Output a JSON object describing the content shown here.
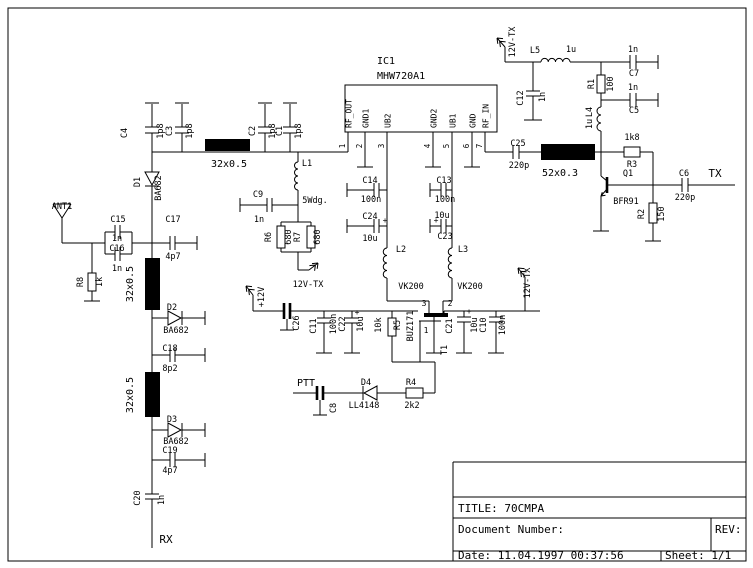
{
  "schematic": {
    "ic": {
      "ref": "IC1",
      "part": "MHW720A1",
      "pin_names": [
        "RF_OUT",
        "GND1",
        "UB2",
        "GND2",
        "UB1",
        "GND",
        "RF_IN"
      ],
      "pin_numbers": [
        "1",
        "2",
        "3",
        "4",
        "5",
        "6",
        "7"
      ]
    },
    "title_block": {
      "title": "TITLE: 70CMPA",
      "document_number": "Document Number:",
      "rev": "REV:",
      "date": "Date: 11.04.1997  00:37:56",
      "sheet": "Sheet: 1/1"
    },
    "labels": [
      {
        "n": "c4-ref",
        "t": "C4",
        "x": 127,
        "y": 133,
        "r": -90
      },
      {
        "n": "c4-val",
        "t": "1p8",
        "x": 163,
        "y": 131,
        "r": -90
      },
      {
        "n": "c3-ref",
        "t": "C3",
        "x": 172,
        "y": 131,
        "r": -90
      },
      {
        "n": "c3-val",
        "t": "1p8",
        "x": 192,
        "y": 131,
        "r": -90
      },
      {
        "n": "c2-ref",
        "t": "C2",
        "x": 255,
        "y": 131,
        "r": -90
      },
      {
        "n": "c2-val",
        "t": "1p8",
        "x": 275,
        "y": 131,
        "r": -90
      },
      {
        "n": "c1-ref",
        "t": "C1",
        "x": 282,
        "y": 131,
        "r": -90
      },
      {
        "n": "c1-val",
        "t": "1p8",
        "x": 301,
        "y": 131,
        "r": -90
      },
      {
        "n": "coax1-label",
        "t": "32x0.5",
        "x": 229,
        "y": 167,
        "s": 10
      },
      {
        "n": "ant-ref",
        "t": "ANT1",
        "x": 62,
        "y": 209
      },
      {
        "n": "d1-ref",
        "t": "D1",
        "x": 140,
        "y": 182,
        "r": -90
      },
      {
        "n": "d1-val",
        "t": "BA682",
        "x": 161,
        "y": 188,
        "r": -90
      },
      {
        "n": "c15-ref",
        "t": "C15",
        "x": 118,
        "y": 222
      },
      {
        "n": "c15-val",
        "t": "1n",
        "x": 117,
        "y": 241
      },
      {
        "n": "c16-ref",
        "t": "C16",
        "x": 117,
        "y": 251
      },
      {
        "n": "c16-val",
        "t": "1n",
        "x": 117,
        "y": 271
      },
      {
        "n": "c17-ref",
        "t": "C17",
        "x": 173,
        "y": 222
      },
      {
        "n": "c17-val",
        "t": "4p7",
        "x": 173,
        "y": 259
      },
      {
        "n": "r8-ref",
        "t": "R8",
        "x": 83,
        "y": 282,
        "r": -90
      },
      {
        "n": "r8-val",
        "t": "1k",
        "x": 102,
        "y": 282,
        "r": -90
      },
      {
        "n": "coax2-label",
        "t": "32x0.5",
        "x": 133,
        "y": 284,
        "r": -90,
        "s": 10
      },
      {
        "n": "d2-ref",
        "t": "D2",
        "x": 172,
        "y": 310
      },
      {
        "n": "d2-val",
        "t": "BA682",
        "x": 176,
        "y": 333
      },
      {
        "n": "c18-ref",
        "t": "C18",
        "x": 170,
        "y": 351
      },
      {
        "n": "c18-val",
        "t": "8p2",
        "x": 170,
        "y": 371
      },
      {
        "n": "coax3-label",
        "t": "32x0.5",
        "x": 133,
        "y": 395,
        "r": -90,
        "s": 10
      },
      {
        "n": "d3-ref",
        "t": "D3",
        "x": 172,
        "y": 422
      },
      {
        "n": "d3-val",
        "t": "BA682",
        "x": 176,
        "y": 444
      },
      {
        "n": "c19-ref",
        "t": "C19",
        "x": 170,
        "y": 453
      },
      {
        "n": "c19-val",
        "t": "4p7",
        "x": 170,
        "y": 473
      },
      {
        "n": "c20-ref",
        "t": "C20",
        "x": 140,
        "y": 498,
        "r": -90
      },
      {
        "n": "c20-val",
        "t": "1n",
        "x": 164,
        "y": 500,
        "r": -90
      },
      {
        "n": "rx-port",
        "t": "RX",
        "x": 166,
        "y": 543,
        "s": 11
      },
      {
        "n": "l1-ref",
        "t": "L1",
        "x": 307,
        "y": 166
      },
      {
        "n": "c9-ref",
        "t": "C9",
        "x": 258,
        "y": 197
      },
      {
        "n": "c9-val",
        "t": "1n",
        "x": 259,
        "y": 222
      },
      {
        "n": "l1-note",
        "t": "5Wdg.",
        "x": 315,
        "y": 203
      },
      {
        "n": "r6-ref",
        "t": "R6",
        "x": 271,
        "y": 237,
        "r": -90
      },
      {
        "n": "r6-val",
        "t": "680",
        "x": 291,
        "y": 237,
        "r": -90
      },
      {
        "n": "r7-ref",
        "t": "R7",
        "x": 300,
        "y": 237,
        "r": -90
      },
      {
        "n": "r7-val",
        "t": "680",
        "x": 320,
        "y": 237,
        "r": -90
      },
      {
        "n": "supply-12vtx-mid",
        "t": "12V-TX",
        "x": 308,
        "y": 287
      },
      {
        "n": "supply-plus12v",
        "t": "+12V",
        "x": 264,
        "y": 297,
        "r": -90
      },
      {
        "n": "c14-ref",
        "t": "C14",
        "x": 370,
        "y": 183
      },
      {
        "n": "c14-val",
        "t": "100n",
        "x": 371,
        "y": 202
      },
      {
        "n": "c24-ref",
        "t": "C24",
        "x": 370,
        "y": 219
      },
      {
        "n": "c24-plus",
        "t": "+",
        "x": 385,
        "y": 223,
        "s": 8
      },
      {
        "n": "c24-val",
        "t": "10u",
        "x": 370,
        "y": 241
      },
      {
        "n": "l2-ref",
        "t": "L2",
        "x": 401,
        "y": 252
      },
      {
        "n": "l2-val",
        "t": "VK200",
        "x": 411,
        "y": 289
      },
      {
        "n": "c13-ref",
        "t": "C13",
        "x": 444,
        "y": 183
      },
      {
        "n": "c13-val",
        "t": "100n",
        "x": 445,
        "y": 202
      },
      {
        "n": "c23-val",
        "t": "10u",
        "x": 442,
        "y": 218
      },
      {
        "n": "c23-plus",
        "t": "+",
        "x": 436,
        "y": 223,
        "s": 8
      },
      {
        "n": "c23-ref",
        "t": "C23",
        "x": 445,
        "y": 239
      },
      {
        "n": "l3-ref",
        "t": "L3",
        "x": 463,
        "y": 252
      },
      {
        "n": "l3-val",
        "t": "VK200",
        "x": 470,
        "y": 289
      },
      {
        "n": "c26-ref",
        "t": "C26",
        "x": 299,
        "y": 323,
        "r": -90
      },
      {
        "n": "c11-ref",
        "t": "C11",
        "x": 316,
        "y": 326,
        "r": -90
      },
      {
        "n": "c11-val",
        "t": "100n",
        "x": 336,
        "y": 324,
        "r": -90
      },
      {
        "n": "c22-ref",
        "t": "C22",
        "x": 345,
        "y": 324,
        "r": -90
      },
      {
        "n": "c22-plus",
        "t": "+",
        "x": 357,
        "y": 315,
        "s": 8
      },
      {
        "n": "c22-val",
        "t": "10u",
        "x": 363,
        "y": 324,
        "r": -90
      },
      {
        "n": "r5-val",
        "t": "10k",
        "x": 381,
        "y": 325,
        "r": -90
      },
      {
        "n": "r5-ref",
        "t": "R5",
        "x": 400,
        "y": 325,
        "r": -90
      },
      {
        "n": "t1-val",
        "t": "BUZ171",
        "x": 413,
        "y": 326,
        "r": -90
      },
      {
        "n": "t1-pin3",
        "t": "3",
        "x": 424,
        "y": 306,
        "s": 8
      },
      {
        "n": "t1-pin2",
        "t": "2",
        "x": 450,
        "y": 306,
        "s": 8
      },
      {
        "n": "t1-pin1",
        "t": "1",
        "x": 426,
        "y": 333,
        "s": 8
      },
      {
        "n": "t1-ref",
        "t": "T1",
        "x": 447,
        "y": 350,
        "r": -90
      },
      {
        "n": "c21-ref",
        "t": "C21",
        "x": 452,
        "y": 326,
        "r": -90
      },
      {
        "n": "c21-plus",
        "t": "+",
        "x": 469,
        "y": 314,
        "s": 8
      },
      {
        "n": "c21-val",
        "t": "10u",
        "x": 477,
        "y": 325,
        "r": -90
      },
      {
        "n": "c10-ref",
        "t": "C10",
        "x": 486,
        "y": 325,
        "r": -90
      },
      {
        "n": "c10-val",
        "t": "100n",
        "x": 505,
        "y": 325,
        "r": -90
      },
      {
        "n": "supply-12vtx-right",
        "t": "12V-TX",
        "x": 530,
        "y": 283,
        "r": -90
      },
      {
        "n": "ptt-port",
        "t": "PTT",
        "x": 306,
        "y": 386,
        "s": 10
      },
      {
        "n": "c8-ref",
        "t": "C8",
        "x": 336,
        "y": 408,
        "r": -90
      },
      {
        "n": "d4-ref",
        "t": "D4",
        "x": 366,
        "y": 385
      },
      {
        "n": "d4-val",
        "t": "LL4148",
        "x": 364,
        "y": 408
      },
      {
        "n": "r4-ref",
        "t": "R4",
        "x": 411,
        "y": 385
      },
      {
        "n": "r4-val",
        "t": "2k2",
        "x": 412,
        "y": 408
      },
      {
        "n": "c25-ref",
        "t": "C25",
        "x": 518,
        "y": 146
      },
      {
        "n": "c25-val",
        "t": "220p",
        "x": 519,
        "y": 168
      },
      {
        "n": "coax4-label",
        "t": "52x0.3",
        "x": 560,
        "y": 176,
        "s": 10
      },
      {
        "n": "supply-12vtx-top",
        "t": "12V-TX",
        "x": 515,
        "y": 42,
        "r": -90
      },
      {
        "n": "l5-ref",
        "t": "L5",
        "x": 535,
        "y": 53
      },
      {
        "n": "l5-val",
        "t": "1u",
        "x": 571,
        "y": 52
      },
      {
        "n": "c12-ref",
        "t": "C12",
        "x": 523,
        "y": 98,
        "r": -90
      },
      {
        "n": "c12-val",
        "t": "1n",
        "x": 545,
        "y": 97,
        "r": -90
      },
      {
        "n": "c7-val",
        "t": "1n",
        "x": 633,
        "y": 52
      },
      {
        "n": "c7-ref",
        "t": "C7",
        "x": 634,
        "y": 76
      },
      {
        "n": "r1-ref",
        "t": "R1",
        "x": 594,
        "y": 84,
        "r": -90
      },
      {
        "n": "r1-val",
        "t": "100",
        "x": 613,
        "y": 84,
        "r": -90
      },
      {
        "n": "c5-val",
        "t": "1n",
        "x": 633,
        "y": 90
      },
      {
        "n": "c5-ref",
        "t": "C5",
        "x": 634,
        "y": 113
      },
      {
        "n": "l4-ref",
        "t": "L4",
        "x": 592,
        "y": 112,
        "r": -90
      },
      {
        "n": "l4-val",
        "t": "1u",
        "x": 592,
        "y": 124,
        "r": -90
      },
      {
        "n": "r3-val",
        "t": "1k8",
        "x": 632,
        "y": 140
      },
      {
        "n": "r3-ref",
        "t": "R3",
        "x": 632,
        "y": 167
      },
      {
        "n": "q1-ref",
        "t": "Q1",
        "x": 628,
        "y": 176
      },
      {
        "n": "q1-val",
        "t": "BFR91",
        "x": 626,
        "y": 204
      },
      {
        "n": "r2-ref",
        "t": "R2",
        "x": 644,
        "y": 214,
        "r": -90
      },
      {
        "n": "r2-val",
        "t": "150",
        "x": 664,
        "y": 214,
        "r": -90
      },
      {
        "n": "c6-ref",
        "t": "C6",
        "x": 684,
        "y": 176
      },
      {
        "n": "c6-val",
        "t": "220p",
        "x": 685,
        "y": 200
      },
      {
        "n": "tx-port",
        "t": "TX",
        "x": 715,
        "y": 177,
        "s": 11
      }
    ]
  }
}
